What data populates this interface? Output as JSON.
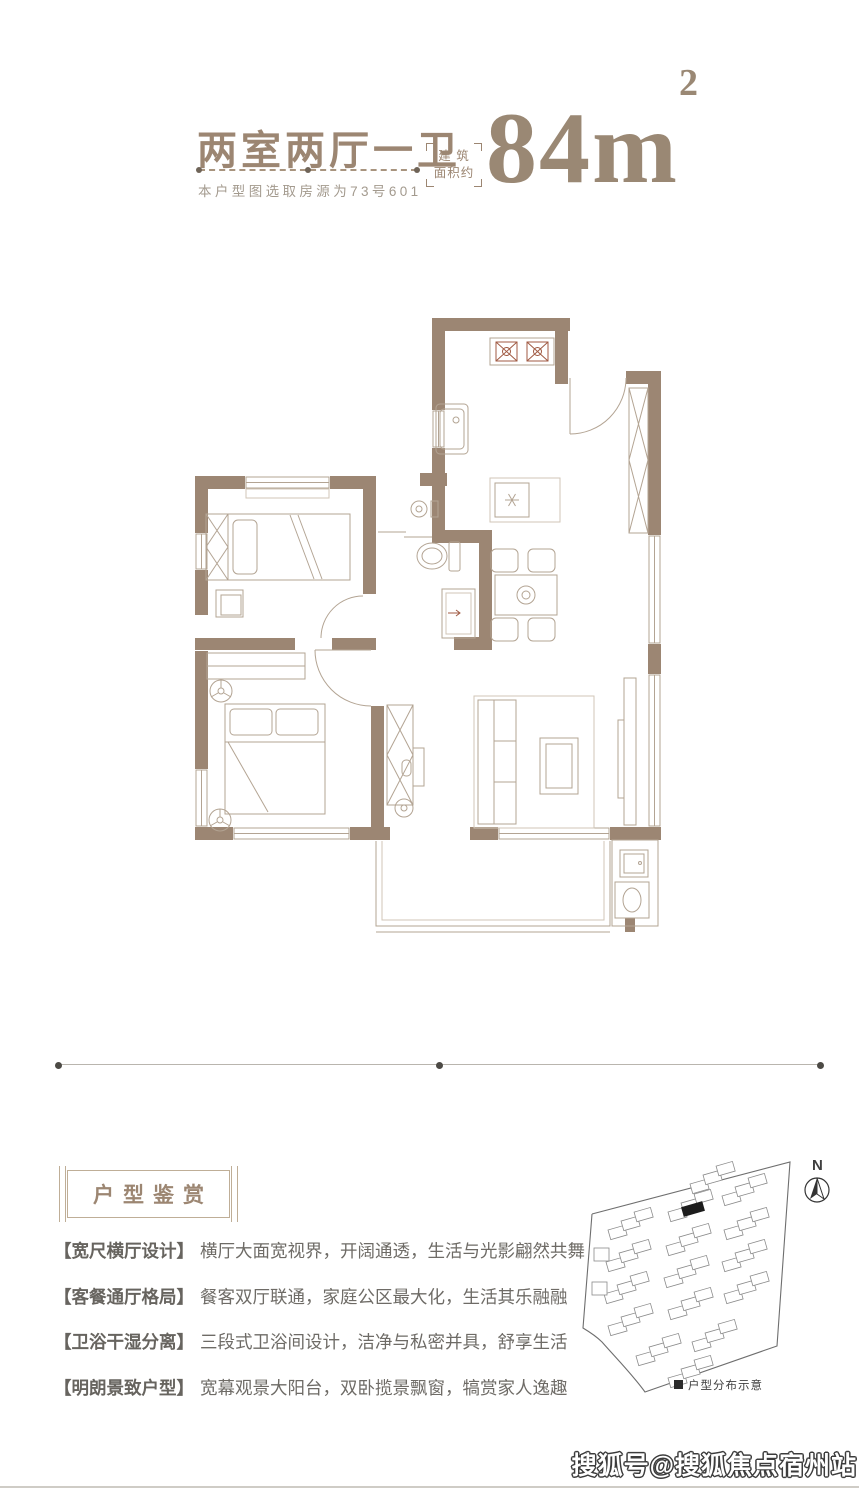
{
  "header": {
    "title": "两室两厅一卫",
    "subtitle": "本户型图选取房源为73号601",
    "area_label_line1": "建 筑",
    "area_label_line2": "面积约",
    "area_value": "84m",
    "area_exponent": "2"
  },
  "floor_plan": {
    "wall_color": "#9c8673",
    "furniture_line_color": "#b3a493",
    "fixtures": [
      "stove-icon",
      "kitchen-sink-icon",
      "fridge-icon",
      "dining-table-icon",
      "dining-chair-icon",
      "washbasin-icon",
      "toilet-icon",
      "shower-icon",
      "single-bed-icon",
      "double-bed-icon",
      "wardrobe-icon",
      "closet-hanger-icon",
      "nightstand-icon",
      "ceiling-fan-icon",
      "sofa-icon",
      "coffee-table-icon",
      "tv-icon",
      "desk-icon",
      "washing-machine-icon",
      "bathroom-sink-icon",
      "entry-door-arc-icon",
      "window-icon",
      "balcony-railing-icon"
    ]
  },
  "appreciation": {
    "heading": "户型鉴赏",
    "items": [
      {
        "tag": "【宽尺横厅设计】",
        "text": "横厅大面宽视界，开阔通透，生活与光影翩然共舞"
      },
      {
        "tag": "【客餐通厅格局】",
        "text": "餐客双厅联通，家庭公区最大化，生活其乐融融"
      },
      {
        "tag": "【卫浴干湿分离】",
        "text": "三段式卫浴间设计，洁净与私密并具，舒享生活"
      },
      {
        "tag": "【明朗景致户型】",
        "text": "宽幕观景大阳台，双卧揽景飘窗，犒赏家人逸趣"
      }
    ]
  },
  "site_plan": {
    "north_label": "N",
    "legend": "户型分布示意",
    "highlight_color": "#1c1c1c"
  },
  "watermark": "搜狐号@搜狐焦点宿州站",
  "colors": {
    "accent": "#9c8672",
    "body_text": "#6e6b66",
    "subtitle_gray": "#a39a8e"
  }
}
